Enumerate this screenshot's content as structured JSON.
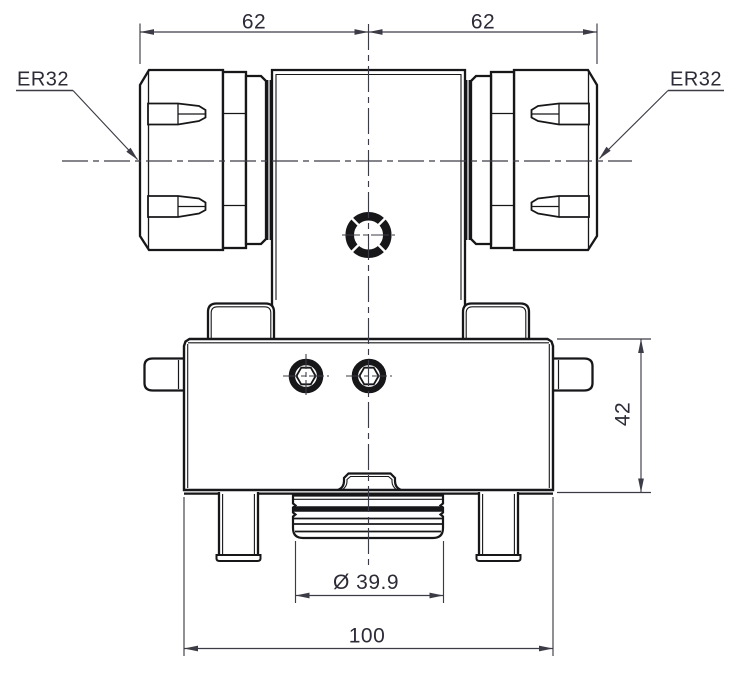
{
  "drawing": {
    "labels": {
      "left_collet": "ER32",
      "right_collet": "ER32"
    },
    "dimensions": {
      "top_left_width": "62",
      "top_right_width": "62",
      "base_height": "42",
      "spigot_diameter": "Ø 39.9",
      "overall_width": "100"
    },
    "colors": {
      "background": "#ffffff",
      "outline": "#17171a",
      "annotation": "#3c3c46",
      "text": "#2c2c38"
    }
  }
}
